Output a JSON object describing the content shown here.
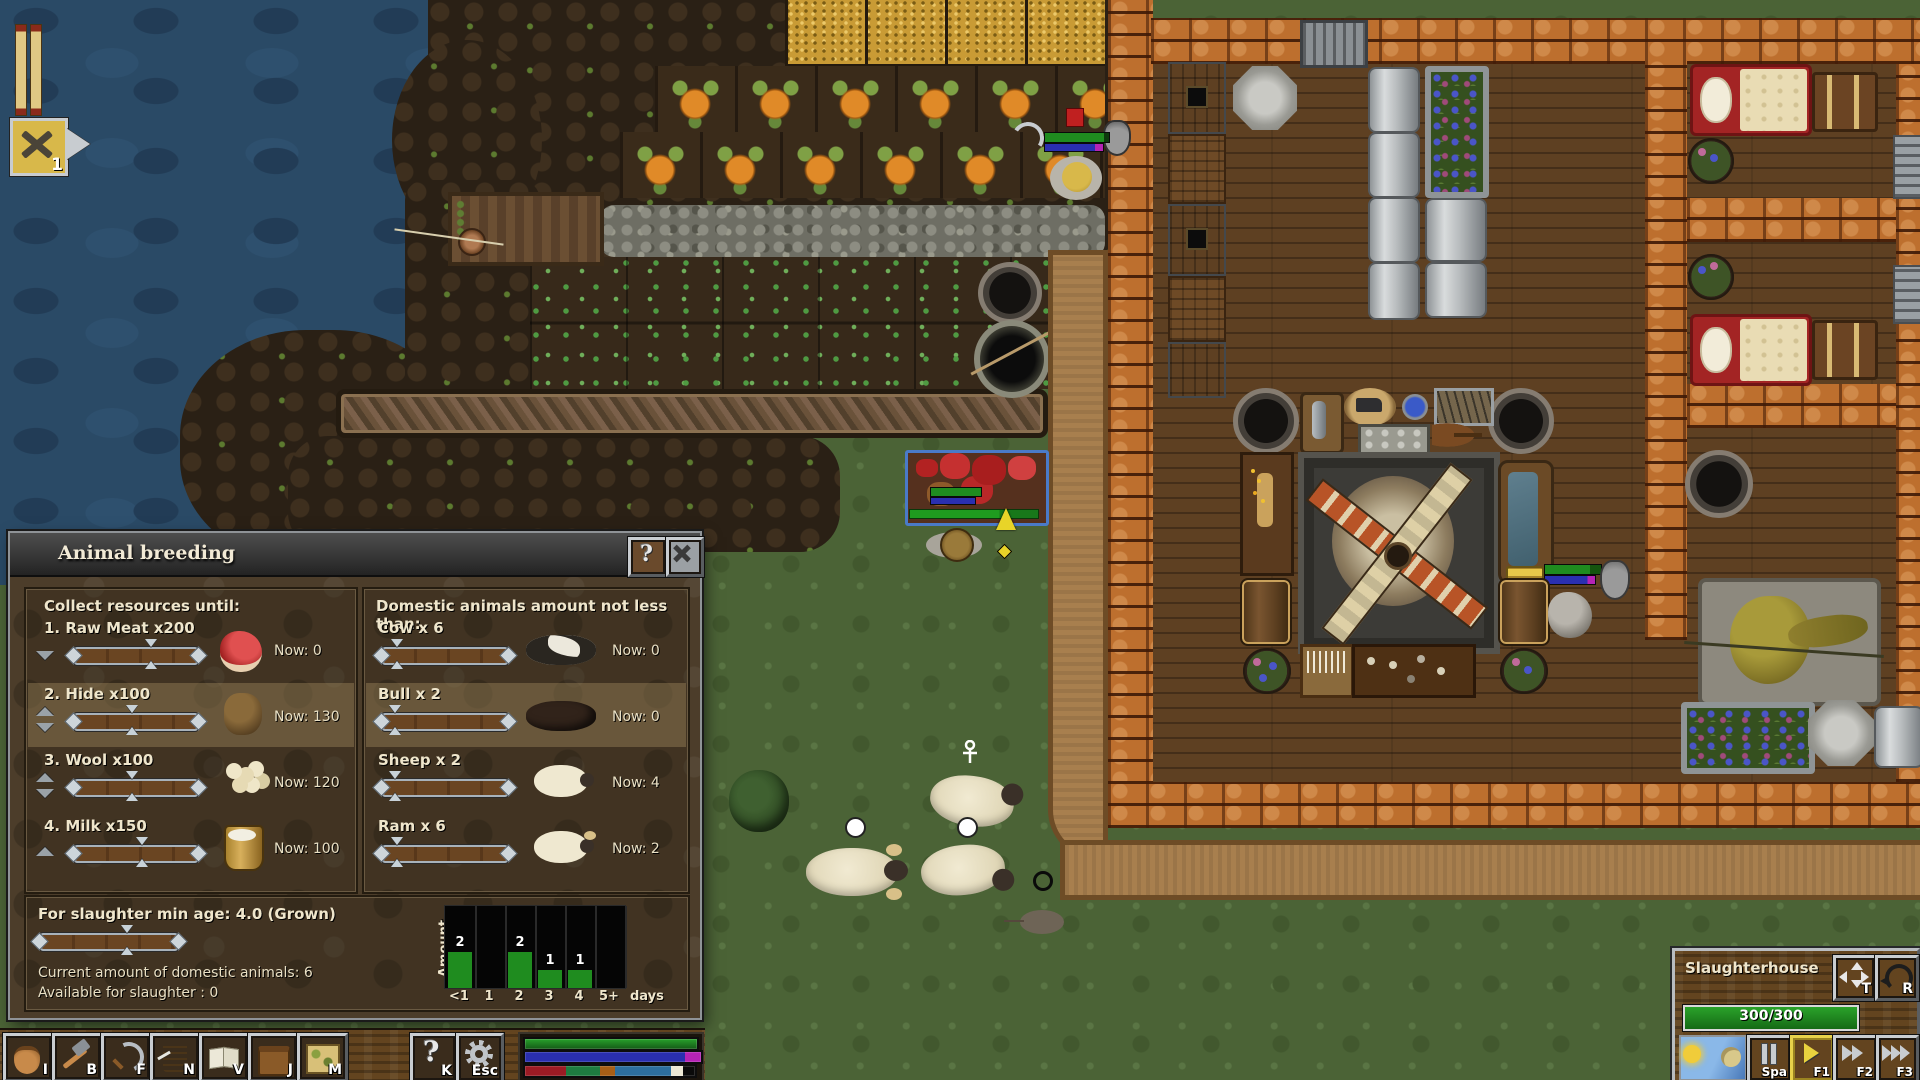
{
  "hud": {
    "task_badge_count": "1"
  },
  "dialog": {
    "title": "Animal breeding",
    "help_glyph": "?",
    "resources": {
      "header": "Collect resources until:",
      "items": [
        {
          "label": "1. Raw Meat x200",
          "now": "Now: 0",
          "slider_pct": 62,
          "icon": "raw-meat"
        },
        {
          "label": "2. Hide x100",
          "now": "Now: 130",
          "slider_pct": 47,
          "icon": "hide"
        },
        {
          "label": "3. Wool x100",
          "now": "Now: 120",
          "slider_pct": 47,
          "icon": "wool"
        },
        {
          "label": "4. Milk x150",
          "now": "Now: 100",
          "slider_pct": 55,
          "icon": "milk-bucket"
        }
      ]
    },
    "animals": {
      "header": "Domestic animals amount not less than:",
      "items": [
        {
          "label": "Cow x 6",
          "now": "Now: 0",
          "slider_pct": 12,
          "icon": "cow"
        },
        {
          "label": "Bull x 2",
          "now": "Now: 0",
          "slider_pct": 10,
          "icon": "bull"
        },
        {
          "label": "Sheep x 2",
          "now": "Now: 4",
          "slider_pct": 10,
          "icon": "sheep"
        },
        {
          "label": "Ram x 6",
          "now": "Now: 2",
          "slider_pct": 12,
          "icon": "ram"
        }
      ]
    },
    "slaughter": {
      "min_age_label": "For slaughter min age: 4.0 (Grown)",
      "slider_pct": 63,
      "current_label": "Current amount of domestic animals: 6",
      "available_label": "Available for slaughter : 0"
    }
  },
  "chart_data": {
    "type": "bar",
    "categories": [
      "<1",
      "1",
      "2",
      "3",
      "4",
      "5+"
    ],
    "values": [
      2,
      0,
      2,
      1,
      1,
      0
    ],
    "title": "",
    "xlabel": "days",
    "ylabel": "Amount",
    "x_suffix": "days",
    "ylim": [
      0,
      4
    ],
    "bar_color": "#1f8c1f",
    "plot_background": "#050505"
  },
  "toolbar": {
    "buttons": [
      {
        "shortcut": "I"
      },
      {
        "shortcut": "B"
      },
      {
        "shortcut": "F"
      },
      {
        "shortcut": "N"
      },
      {
        "shortcut": "V"
      },
      {
        "shortcut": "J"
      },
      {
        "shortcut": "M"
      }
    ],
    "help_glyph": "?",
    "help_shortcut": "K",
    "settings_shortcut": "Esc"
  },
  "status_bars": {
    "food_bar_color": "#28a12c",
    "water_bar_color": "#2a2fb0",
    "water_bar_tip_color": "#b523b5",
    "segments": [
      {
        "color": "#9c1b24",
        "pct": 24
      },
      {
        "color": "#1e7c40",
        "pct": 20
      },
      {
        "color": "#a85f16",
        "pct": 9
      },
      {
        "color": "#2d6f9e",
        "pct": 33
      },
      {
        "color": "#ece8d4",
        "pct": 7
      },
      {
        "color": "#0a0a0a",
        "pct": 7
      }
    ]
  },
  "building_panel": {
    "title": "Slaughterhouse",
    "hp": "300/300",
    "hp_color": "#2aa22a",
    "move_shortcut": "T",
    "rotate_shortcut": "R",
    "pause_shortcut": "Spa",
    "speed1_shortcut": "F1",
    "speed2_shortcut": "F2",
    "speed3_shortcut": "F3"
  }
}
